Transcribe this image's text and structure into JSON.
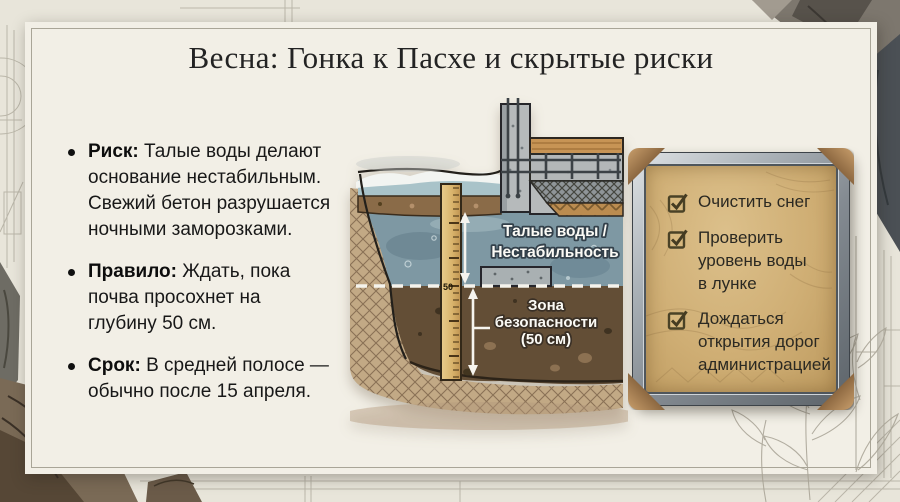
{
  "title": "Весна: Гонка к Пасхе и скрытые риски",
  "bullets": [
    {
      "label": "Риск:",
      "lines": [
        "Талые воды делают",
        "основание нестабильным.",
        "Свежий бетон разрушается",
        "ночными заморозками."
      ]
    },
    {
      "label": "Правило:",
      "lines": [
        "Ждать, пока",
        "почва просохнет на",
        "глубину 50 см."
      ]
    },
    {
      "label": "Срок:",
      "lines": [
        "В средней полосе —",
        "обычно после 15 апреля."
      ]
    }
  ],
  "diagram": {
    "water_label_line1": "Талые воды /",
    "water_label_line2": "Нестабильность",
    "zone_label_line1": "Зона",
    "zone_label_line2": "безопасности",
    "zone_label_line3": "(50 см)",
    "ruler_mark": "50"
  },
  "checklist": {
    "items": [
      {
        "checked": true,
        "lines": [
          "Очистить снег",
          "",
          ""
        ]
      },
      {
        "checked": true,
        "lines": [
          "Проверить",
          "уровень воды",
          "в лунке"
        ]
      },
      {
        "checked": true,
        "lines": [
          "Дождаться",
          "открытия дорог",
          "администрацией"
        ]
      }
    ]
  },
  "colors": {
    "paper": "#f2efe6",
    "background": "#e8e5da",
    "parchment": "#cfae74",
    "metal_frame": "#848b92",
    "bronze_cap": "#86623c",
    "check_mark": "#4a4226",
    "water": "#7e98a3",
    "soil_dark": "#634e36",
    "soil_band": "#8a6b48",
    "ruler_wood": "#d9b46c",
    "concrete": "#b5b9ba",
    "label_text": "#fbfaf5"
  }
}
